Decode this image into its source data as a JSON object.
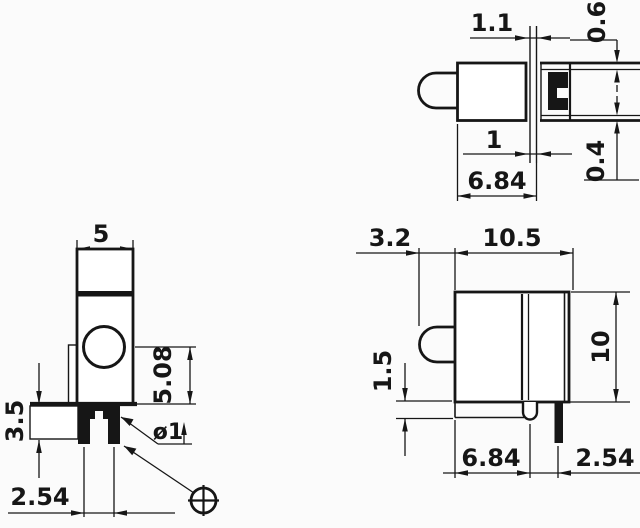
{
  "drawing": {
    "description": "Three-view dimensioned drawing of a right-angle LED holder",
    "ink_color": "#161616",
    "paper_color": "#fbfbfb",
    "views": {
      "top": {
        "dims": {
          "panel_gap": "1.1",
          "edge_offset_top": "0.6",
          "pin_width": "1",
          "body_depth": "6.84",
          "edge_offset_bottom": "0.4"
        }
      },
      "front": {
        "dims": {
          "body_width": "5",
          "led_center_height": "5.08",
          "standoff_height": "3.5",
          "pin_pitch": "2.54",
          "pin_diameter": "ø1"
        },
        "symbols": {
          "index_mark": "crosshair-circle"
        }
      },
      "side": {
        "dims": {
          "lens_protrusion": "3.2",
          "body_depth": "10.5",
          "body_height": "10",
          "tab_height": "1.5",
          "pin_setback": "6.84",
          "pin_pitch": "2.54"
        }
      }
    }
  }
}
